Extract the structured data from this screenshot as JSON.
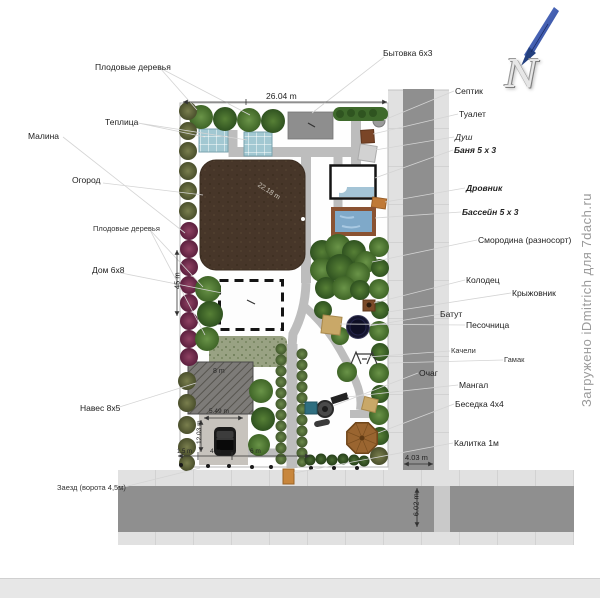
{
  "watermark": "Загружено iDmitrich для 7dach.ru",
  "compass": {
    "letter": "N"
  },
  "labels": {
    "fruit_trees_top": "Плодовые деревья",
    "greenhouse": "Теплица",
    "raspberry": "Малина",
    "garden": "Огород",
    "fruit_trees_left": "Плодовые деревья",
    "house": "Дом 6х8",
    "carport": "Навес 8х5",
    "entrance": "Заезд (ворота 4,5м)",
    "cabin": "Бытовка 6х3",
    "septic": "Септик",
    "toilet": "Туалет",
    "shower": "Душ",
    "bathhouse": "Баня 5 х 3",
    "woodshed": "Дровник",
    "pool": "Бассейн 5 х 3",
    "currant": "Смородина (разносорт)",
    "well": "Колодец",
    "gooseberry": "Крыжовник",
    "trampoline": "Батут",
    "sandbox": "Песочница",
    "swings": "Качели",
    "hammock": "Гамак",
    "firepit": "Очаг",
    "grill": "Мангал",
    "gazebo": "Беседка 4х4",
    "gate": "Калитка 1м"
  },
  "dimensions": {
    "plot_width": "26.04 m",
    "plot_height": "45 m",
    "garden_diagonal": "22.18 m",
    "carport_width": "8 m",
    "parking_width": "5.49 m",
    "parking_depth": "12.03 m",
    "bottom_seg_1": "1.5 m",
    "bottom_seg_2": "4 m",
    "bottom_seg_3": "6 m",
    "side_road_width": "4.03 m",
    "front_road_width": "6.02 m"
  }
}
